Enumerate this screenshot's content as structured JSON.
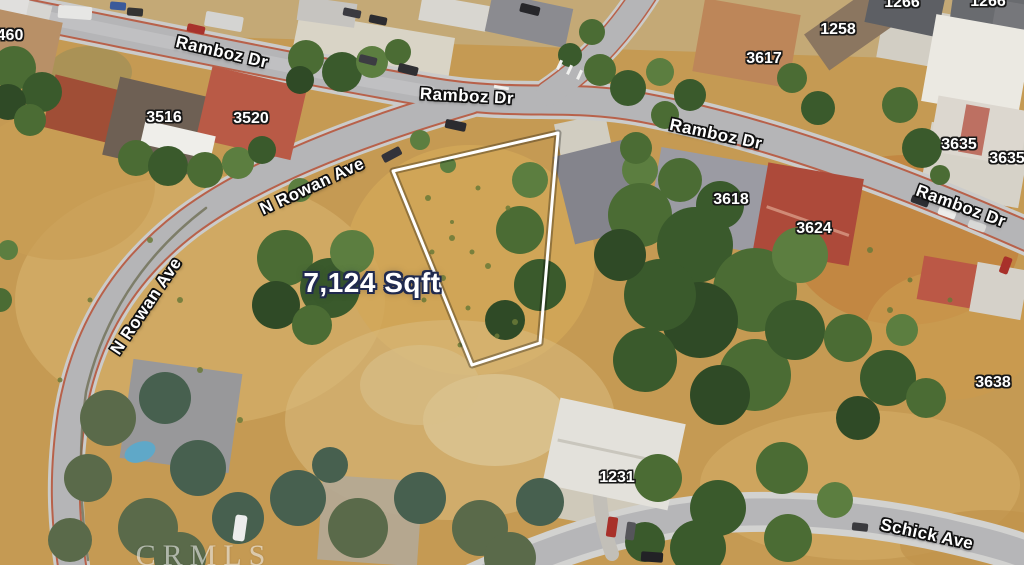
{
  "map": {
    "description": "Aerial satellite view of a vacant land parcel at Ramboz Dr and N Rowan Ave",
    "parcel": {
      "area_text": "7,124 Sqft",
      "outline_points": "558,133 393,171 472,365 540,343",
      "outline_color": "#ffffff",
      "area_label_fill": "#ffffff",
      "area_label_outline": "#202a4e"
    },
    "street_labels": [
      {
        "name": "Ramboz Dr"
      },
      {
        "name": "Ramboz Dr"
      },
      {
        "name": "Ramboz Dr"
      },
      {
        "name": "Ramboz Dr"
      },
      {
        "name": "N Rowan Ave"
      },
      {
        "name": "N Rowan Ave"
      },
      {
        "name": "Schick Ave"
      }
    ],
    "house_numbers": [
      "460",
      "3516",
      "3520",
      "3617",
      "1258",
      "1266",
      "1266",
      "3635",
      "3635",
      "3618",
      "3624",
      "3638",
      "1231"
    ],
    "label_style": {
      "fill": "#ffffff",
      "outline": "#000000"
    },
    "watermark": "CRMLS"
  }
}
